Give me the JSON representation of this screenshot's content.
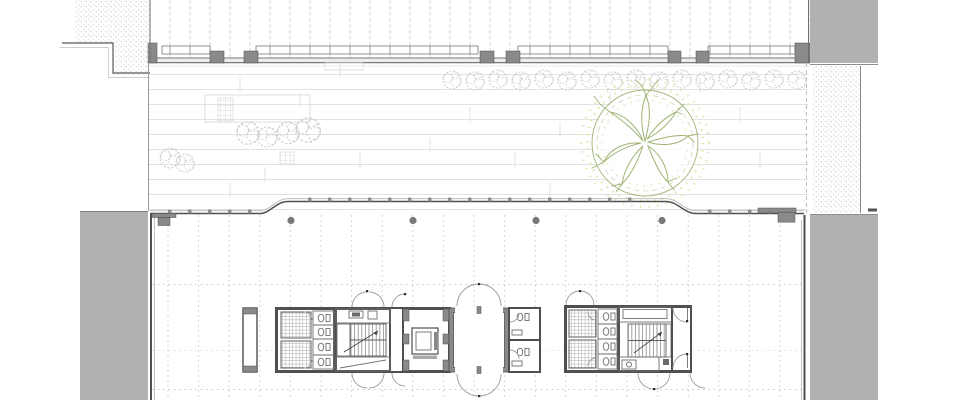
{
  "page": {
    "title": "Ground floor site plan"
  },
  "drawing": {
    "type": "architectural-floor-plan",
    "colors": {
      "background": "#ffffff",
      "solid_mass": "#b1b1b1",
      "wall_dark": "#4f4f4f",
      "wall_mid": "#8a8a8a",
      "line_light": "#e2e2e2",
      "grid_dash": "#c4c4c4",
      "tree_gray": "#cdcdcd",
      "tree_green": "#9fb474",
      "tree_speckle": "#dbe5ad",
      "stipple_dot": "#b8b8b8"
    },
    "grid": {
      "plaza_paving_spacing_px": 15,
      "structural_bay_spacing_px": 31,
      "facade_mullion_spacing_px": 20,
      "roof_joint_spacing_px": 20
    },
    "inventory": {
      "street_trees_in_row": 16,
      "plaza_shrub_clusters": 2,
      "specimen_tree": 1,
      "perimeter_columns": 4,
      "service_cores": 2,
      "stairs": 2,
      "elevator_cars": 1,
      "wc_stalls": 10,
      "tiled_shower_rooms": 4,
      "central_lightwell": 1
    }
  }
}
